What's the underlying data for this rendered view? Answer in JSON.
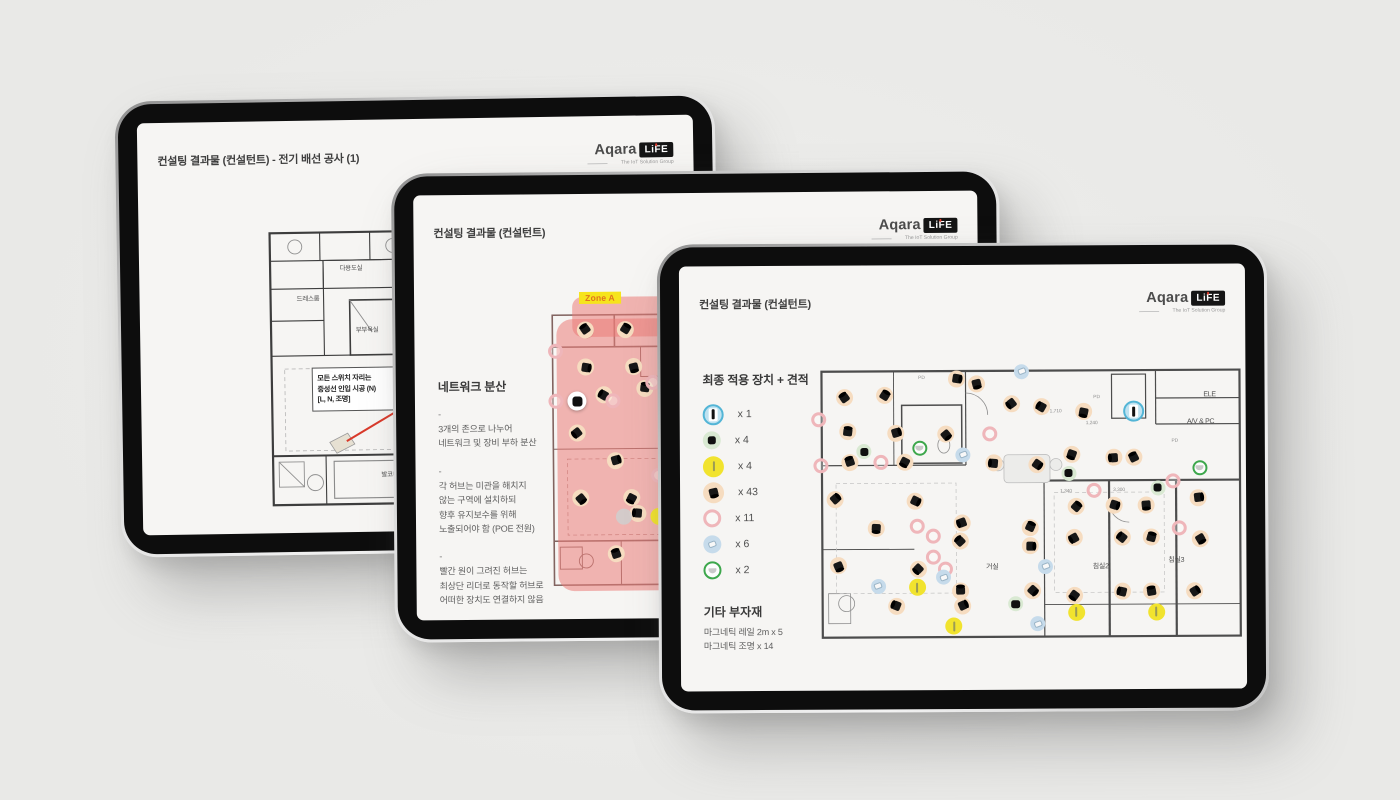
{
  "logo": {
    "brand": "Aqara",
    "badge": "LiFE",
    "tagline": "The IoT Solution Group"
  },
  "bullet_marker": "-",
  "tablet1": {
    "title": "컨설팅 결과물 (컨설턴트) - 전기 배선 공사 (1)",
    "annotation_lines": [
      "모든 스위치 자리는",
      "중성선 인입 시공 (N)",
      "[L, N, 조명]"
    ],
    "room_labels": [
      {
        "text": "다용도실",
        "x": 42.5,
        "y": 16.2
      },
      {
        "text": "드레스룸",
        "x": 21,
        "y": 26.5
      },
      {
        "text": "부부욕실",
        "x": 50,
        "y": 37.2
      },
      {
        "text": "발코니1",
        "x": 61,
        "y": 86.9
      }
    ]
  },
  "tablet2": {
    "title": "컨설팅 결과물 (컨설턴트)",
    "heading": "네트워크 분산",
    "bullets": [
      {
        "lines": [
          "3개의 존으로 나누어",
          "네트워크 및 장비 부하 분산"
        ]
      },
      {
        "lines": [
          "각 허브는 미관을 해치지",
          "않는 구역에 설치하되",
          "향후 유지보수를 위해",
          "노출되어야 함 (POE 전원)"
        ]
      },
      {
        "lines": [
          "빨간 원이 그려진 허브는",
          "최상단 리더로 동작할 허브로",
          "어떠한 장치도 연결하지 않음"
        ]
      }
    ],
    "zone_label": "Zone A",
    "markers": {
      "spot": [
        [
          15,
          13
        ],
        [
          30,
          13
        ],
        [
          15,
          25
        ],
        [
          33,
          25
        ],
        [
          12,
          46
        ],
        [
          22,
          34
        ],
        [
          37,
          32
        ],
        [
          26,
          55
        ],
        [
          13,
          67
        ],
        [
          32,
          67
        ],
        [
          34,
          72
        ],
        [
          26,
          85
        ],
        [
          45,
          20
        ],
        [
          52,
          30
        ],
        [
          48,
          50
        ],
        [
          55,
          65
        ],
        [
          60,
          40
        ],
        [
          58,
          78
        ]
      ],
      "ring": [
        [
          4,
          20
        ],
        [
          4,
          36
        ],
        [
          25,
          36
        ],
        [
          40,
          30
        ],
        [
          42,
          60
        ],
        [
          55,
          50
        ]
      ],
      "hub_white": [
        [
          12,
          36
        ]
      ],
      "gray": [
        [
          29,
          73
        ]
      ],
      "light": [
        [
          42,
          73
        ]
      ]
    }
  },
  "tablet3": {
    "title": "컨설팅 결과물 (컨설턴트)",
    "heading": "최종 적용 장치 + 견적",
    "legend": [
      {
        "icon": "gateway",
        "count": "x 1"
      },
      {
        "icon": "hub",
        "count": "x 4"
      },
      {
        "icon": "light",
        "count": "x 4"
      },
      {
        "icon": "spot",
        "count": "x 43"
      },
      {
        "icon": "ring",
        "count": "x 11"
      },
      {
        "icon": "sensor",
        "count": "x 6"
      },
      {
        "icon": "bowl",
        "count": "x 2"
      }
    ],
    "extras_heading": "기타 부자재",
    "extras_lines": [
      "마그네틱 레일 2m x 5",
      "마그네틱 조명 x 14"
    ],
    "room_labels": [
      {
        "text": "거실",
        "x": 40.7,
        "y": 72.2
      },
      {
        "text": "침실2",
        "x": 65.8,
        "y": 72.2
      },
      {
        "text": "침실3",
        "x": 83.3,
        "y": 70.1
      },
      {
        "text": "ELE",
        "x": 91.2,
        "y": 14.6
      },
      {
        "text": "A/V & PC",
        "x": 89.1,
        "y": 23.7
      },
      {
        "text": "PD",
        "x": 24.6,
        "y": 8.5,
        "dim": true
      },
      {
        "text": "PD",
        "x": 65.1,
        "y": 15,
        "dim": true
      },
      {
        "text": "PD",
        "x": 83,
        "y": 30,
        "dim": true
      },
      {
        "text": "1,710",
        "x": 55.5,
        "y": 20,
        "dim": true
      },
      {
        "text": "1,240",
        "x": 64,
        "y": 24,
        "dim": true
      },
      {
        "text": "1,340",
        "x": 57.8,
        "y": 46.9,
        "dim": true
      },
      {
        "text": "3,300",
        "x": 70.2,
        "y": 46.6,
        "dim": true
      }
    ],
    "markers": {
      "spot": [
        [
          6.6,
          14.9
        ],
        [
          15.9,
          14.3
        ],
        [
          32.6,
          8.6
        ],
        [
          37.2,
          10.3
        ],
        [
          45.3,
          17.1
        ],
        [
          52.3,
          18.3
        ],
        [
          7.4,
          26.3
        ],
        [
          18.6,
          26.9
        ],
        [
          30.2,
          27.4
        ],
        [
          20.5,
          36.6
        ],
        [
          41.1,
          37.1
        ],
        [
          7.8,
          36.6
        ],
        [
          4.3,
          49.1
        ],
        [
          22.9,
          49.7
        ],
        [
          14,
          58.9
        ],
        [
          33.7,
          57.1
        ],
        [
          33.3,
          63.4
        ],
        [
          49.6,
          58.9
        ],
        [
          49.6,
          65.1
        ],
        [
          5,
          71.4
        ],
        [
          23.6,
          72.6
        ],
        [
          18.6,
          85.1
        ],
        [
          33.3,
          80
        ],
        [
          33.7,
          85.1
        ],
        [
          50,
          80
        ],
        [
          59.3,
          34.3
        ],
        [
          69,
          35.4
        ],
        [
          73.6,
          35.4
        ],
        [
          60.1,
          52
        ],
        [
          69,
          51.4
        ],
        [
          76.4,
          51.4
        ],
        [
          59.7,
          62.3
        ],
        [
          70.9,
          62.3
        ],
        [
          77.5,
          62.3
        ],
        [
          88.4,
          49.1
        ],
        [
          88.8,
          62.9
        ],
        [
          59.7,
          81.7
        ],
        [
          70.9,
          80.6
        ],
        [
          77.5,
          80.6
        ],
        [
          87.6,
          80.6
        ],
        [
          51.2,
          37.7
        ],
        [
          62,
          20
        ]
      ],
      "ring": [
        [
          0.8,
          22.3
        ],
        [
          1.2,
          37.7
        ],
        [
          15.1,
          36.6
        ],
        [
          40.3,
          27.4
        ],
        [
          23.3,
          58.3
        ],
        [
          27.1,
          61.7
        ],
        [
          27.1,
          68.6
        ],
        [
          29.8,
          72.6
        ],
        [
          64.3,
          46.3
        ],
        [
          82.6,
          43.4
        ],
        [
          84.1,
          59.4
        ]
      ],
      "sensor": [
        [
          47.7,
          6.3
        ],
        [
          34.1,
          34.3
        ],
        [
          14.3,
          78.3
        ],
        [
          53.1,
          72
        ],
        [
          51.2,
          91.4
        ],
        [
          29.5,
          75.5
        ]
      ],
      "light": [
        [
          23.3,
          78.9
        ],
        [
          31.8,
          92
        ],
        [
          60.1,
          87.4
        ],
        [
          78.7,
          87.4
        ]
      ],
      "hub": [
        [
          11.2,
          33.1
        ],
        [
          58.5,
          40.6
        ],
        [
          79.1,
          45.7
        ],
        [
          46.1,
          84.6
        ]
      ],
      "bowl": [
        [
          24,
          32
        ],
        [
          88.8,
          38.9
        ]
      ],
      "gateway": [
        [
          73.6,
          20
        ]
      ]
    }
  },
  "colors": {
    "bg": "#e9e9e7",
    "screen": "#f6f5f3",
    "bezel": "#0d0d0d",
    "title_text": "#3f3f3f",
    "body_text": "#5f5f5f",
    "accent_red": "#d93a2b",
    "pink_overlay": "rgba(235,124,120,0.55)",
    "zone_yellow": "#f6e41c",
    "zone_text": "#e0741e",
    "marker_spot_bg": "#f6dcc0",
    "marker_ring": "#efb6ba",
    "marker_sensor_bg": "#c6dbeb",
    "marker_light_bg": "#f1e32e",
    "marker_hub_bg": "#d9e9d2",
    "marker_bowl_ring": "#3da74c",
    "marker_gateway_bg": "#bfe2f0",
    "marker_gateway_ring": "#53b5d6"
  }
}
